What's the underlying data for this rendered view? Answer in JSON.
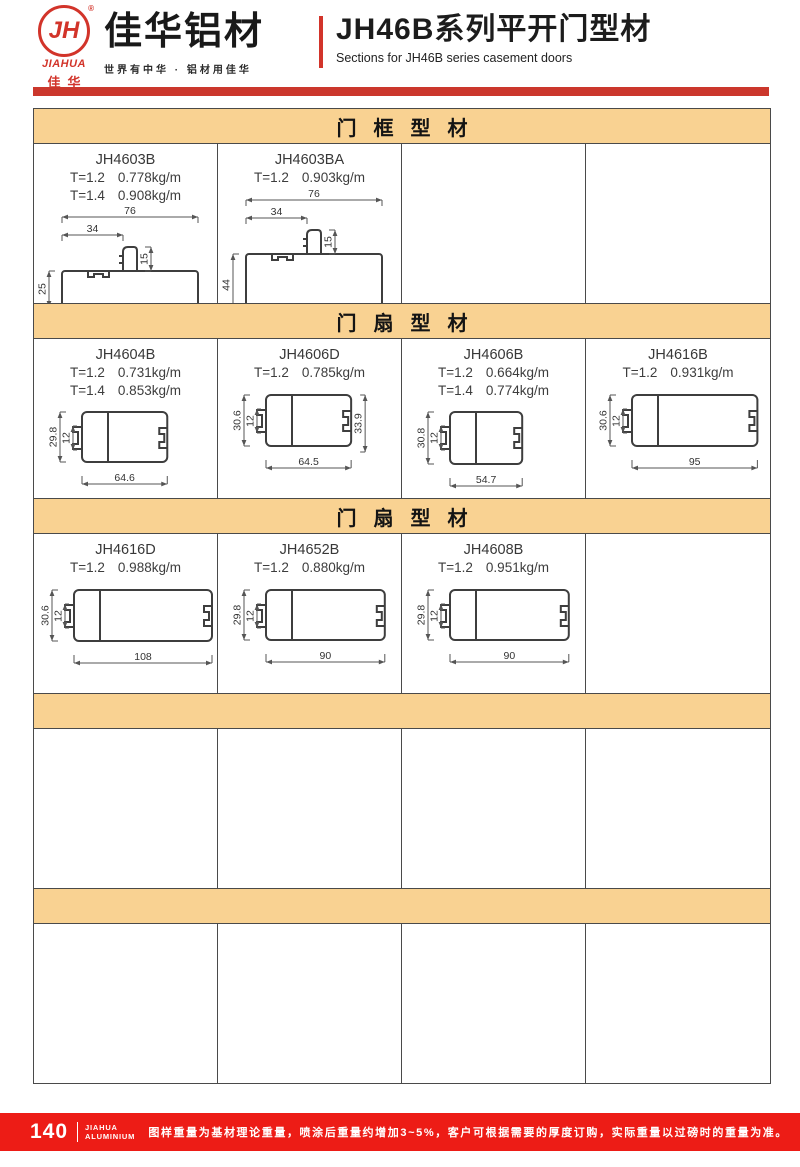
{
  "colors": {
    "brand_red": "#d2342a",
    "top_bar_red": "#cb372c",
    "footer_red": "#ed1c16",
    "section_tan": "#f9d292",
    "table_border": "#4a4a4a"
  },
  "header": {
    "logo_monogram": "JH",
    "logo_reg_mark": "®",
    "logo_en": "JIAHUA",
    "logo_cn": "佳华",
    "brand_name": "佳华铝材",
    "brand_tagline": "世界有中华 · 铝材用佳华",
    "doc_title": "JH46B系列平开门型材",
    "doc_subtitle": "Sections for JH46B series casement doors"
  },
  "sections": [
    {
      "title": "门框型材",
      "cells": [
        {
          "code": "JH4603B",
          "specs": [
            {
              "t": "T=1.2",
              "w": "0.778kg/m"
            },
            {
              "t": "T=1.4",
              "w": "0.908kg/m"
            }
          ],
          "drawing": {
            "kind": "frame",
            "base_h": 25,
            "dims": {
              "top": "76",
              "offset": "34",
              "stub": "15",
              "left": "25"
            }
          }
        },
        {
          "code": "JH4603BA",
          "specs": [
            {
              "t": "T=1.2",
              "w": "0.903kg/m"
            }
          ],
          "drawing": {
            "kind": "frame",
            "base_h": 44,
            "dims": {
              "top": "76",
              "offset": "34",
              "stub": "15",
              "left": "44"
            }
          }
        },
        null,
        null
      ]
    },
    {
      "title": "门扇型材",
      "cells": [
        {
          "code": "JH4604B",
          "specs": [
            {
              "t": "T=1.2",
              "w": "0.731kg/m"
            },
            {
              "t": "T=1.4",
              "w": "0.853kg/m"
            }
          ],
          "drawing": {
            "kind": "sash",
            "dims": {
              "left": "29.8",
              "inner": "12",
              "bottom": "64.6"
            }
          }
        },
        {
          "code": "JH4606D",
          "specs": [
            {
              "t": "T=1.2",
              "w": "0.785kg/m"
            }
          ],
          "drawing": {
            "kind": "sash",
            "dims": {
              "left": "30.6",
              "inner": "12",
              "bottom": "64.5",
              "right": "33.9"
            }
          }
        },
        {
          "code": "JH4606B",
          "specs": [
            {
              "t": "T=1.2",
              "w": "0.664kg/m"
            },
            {
              "t": "T=1.4",
              "w": "0.774kg/m"
            }
          ],
          "drawing": {
            "kind": "sash",
            "dims": {
              "left": "30.8",
              "inner": "12",
              "bottom": "54.7"
            }
          }
        },
        {
          "code": "JH4616B",
          "specs": [
            {
              "t": "T=1.2",
              "w": "0.931kg/m"
            }
          ],
          "drawing": {
            "kind": "sash",
            "dims": {
              "left": "30.6",
              "inner": "12",
              "bottom": "95"
            }
          }
        }
      ]
    },
    {
      "title": "门扇型材",
      "cells": [
        {
          "code": "JH4616D",
          "specs": [
            {
              "t": "T=1.2",
              "w": "0.988kg/m"
            }
          ],
          "drawing": {
            "kind": "sash",
            "dims": {
              "left": "30.6",
              "inner": "12",
              "bottom": "108"
            }
          }
        },
        {
          "code": "JH4652B",
          "specs": [
            {
              "t": "T=1.2",
              "w": "0.880kg/m"
            }
          ],
          "drawing": {
            "kind": "sash",
            "dims": {
              "left": "29.8",
              "inner": "12",
              "bottom": "90"
            }
          }
        },
        {
          "code": "JH4608B",
          "specs": [
            {
              "t": "T=1.2",
              "w": "0.951kg/m"
            }
          ],
          "drawing": {
            "kind": "sash",
            "dims": {
              "left": "29.8",
              "inner": "12",
              "bottom": "90"
            }
          }
        },
        null
      ]
    },
    {
      "title": "",
      "cells": [
        null,
        null,
        null,
        null
      ]
    },
    {
      "title": "",
      "cells": [
        null,
        null,
        null,
        null
      ]
    }
  ],
  "footer": {
    "page_number": "140",
    "brand_line1": "JIAHUA",
    "brand_line2": "ALUMINIUM",
    "note": "图样重量为基材理论重量，喷涂后重量约增加3~5%，客户可根据需要的厚度订购，实际重量以过磅时的重量为准。"
  }
}
